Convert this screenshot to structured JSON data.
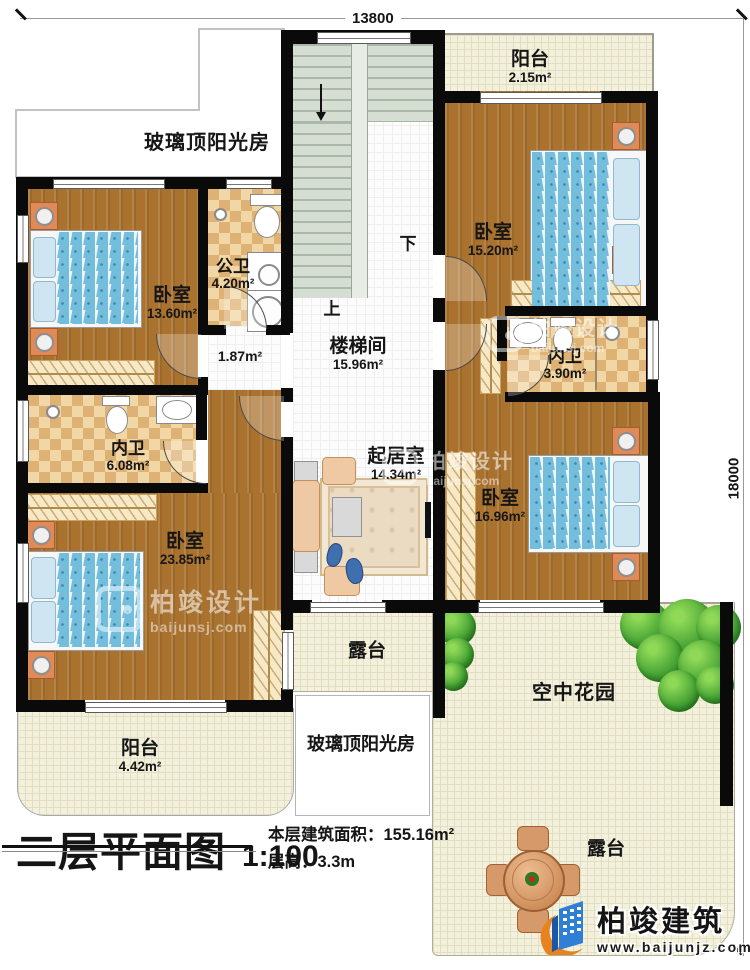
{
  "dimensions": {
    "width_mm": "13800",
    "height_mm": "18000"
  },
  "rooms": {
    "balcony_tr": {
      "name": "阳台",
      "area": "2.15m²"
    },
    "bedroom_tr": {
      "name": "卧室",
      "area": "15.20m²"
    },
    "sunroom_top": {
      "name": "玻璃顶阳光房"
    },
    "bedroom_tl": {
      "name": "卧室",
      "area": "13.60m²"
    },
    "public_bath": {
      "name": "公卫",
      "area": "4.20m²"
    },
    "hallway": {
      "area": "1.87m²"
    },
    "stair_hall": {
      "name": "楼梯间",
      "area": "15.96m²"
    },
    "bath_right": {
      "name": "内卫",
      "area": "3.90m²"
    },
    "bath_left": {
      "name": "内卫",
      "area": "6.08m²"
    },
    "living": {
      "name": "起居室",
      "area": "14.34m²"
    },
    "bedroom_br": {
      "name": "卧室",
      "area": "16.96m²"
    },
    "bedroom_bl": {
      "name": "卧室",
      "area": "23.85m²"
    },
    "balcony_bl": {
      "name": "阳台",
      "area": "4.42m²"
    },
    "terrace_mid": {
      "name": "露台"
    },
    "sunroom_bottom": {
      "name": "玻璃顶阳光房"
    },
    "sky_garden": {
      "name": "空中花园"
    },
    "terrace_br": {
      "name": "露台"
    }
  },
  "stairs": {
    "up_label": "上",
    "down_label": "下"
  },
  "title_block": {
    "title": "二层平面图",
    "scale": "1:100",
    "area_label": "本层建筑面积：",
    "area_value": "155.16m²",
    "height_label": "层高：",
    "height_value": "3.3m"
  },
  "watermark": {
    "brand": "柏竣设计",
    "site": "baijunsj.com"
  },
  "logo": {
    "brand": "柏竣建筑",
    "site": "www.baijunjz.com"
  },
  "colors": {
    "wall": "#0a0a0a",
    "wood_floor": "#a9722f",
    "checker_light": "#f0d7a5",
    "checker_dark": "#ddb274",
    "terrace": "#f3f0dc",
    "bush_green": "#4aa636",
    "bed_blue": "#74bedd",
    "logo_blue": "#2f7fd6",
    "logo_orange": "#e8821e"
  }
}
